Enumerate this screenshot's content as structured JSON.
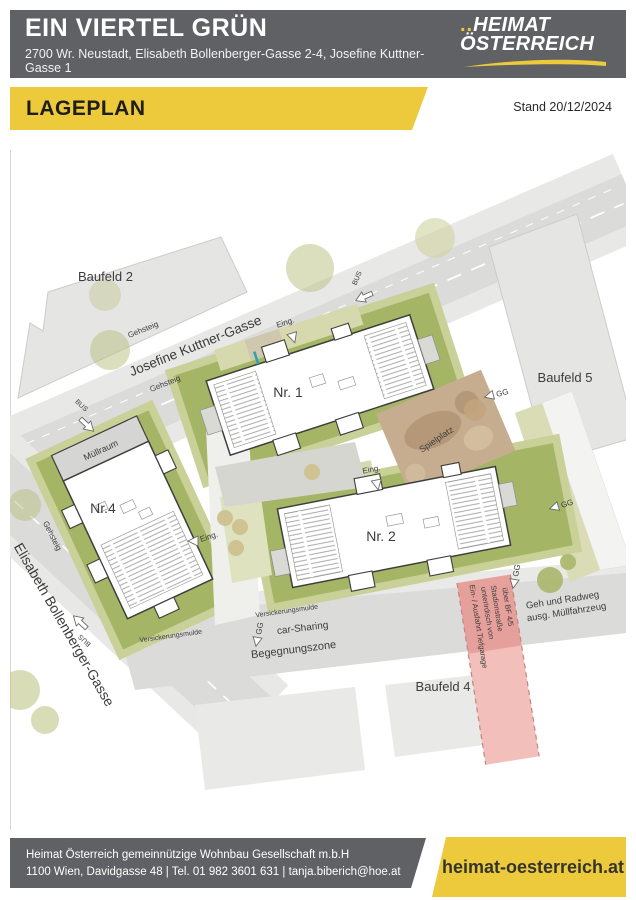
{
  "header": {
    "title": "EIN VIERTEL GRÜN",
    "subtitle": "2700 Wr. Neustadt, Elisabeth Bollenberger-Gasse 2-4, Josefine Kuttner-Gasse 1",
    "logo_dots": "..",
    "logo_line1": "HEIMAT",
    "logo_line2": "ÖSTERREICH"
  },
  "banner": {
    "label": "LAGEPLAN",
    "date": "Stand 20/12/2024"
  },
  "plan": {
    "blocks": {
      "baufeld2": "Baufeld 2",
      "baufeld4": "Baufeld 4",
      "baufeld5": "Baufeld 5"
    },
    "streets": {
      "josefine": "Josefine Kuttner-Gasse",
      "elisabeth": "Elisabeth Bollenberger-Gasse",
      "gehsteig": "Gehsteig",
      "begegnungszone": "Begegnungszone",
      "geh_radweg_1": "Geh und Radweg",
      "geh_radweg_2": "ausg. Müllfahrzeug"
    },
    "buildings": {
      "nr1": "Nr. 1",
      "nr2": "Nr. 2",
      "nr4": "Nr.4",
      "muellraum": "Müllraum"
    },
    "features": {
      "spielplatz": "Spielplatz",
      "car_sharing": "car-Sharing",
      "versickerungsmulde": "Versickerungsmulde",
      "eingang": "Eing.",
      "gg": "GG",
      "bus": "BUS",
      "tg_line1": "Ein- / Ausfahrt Tiefgarage",
      "tg_line2": "unterirdisch von",
      "tg_line3": "Stadionstraße",
      "tg_line4": "über BF 4/5"
    }
  },
  "footer": {
    "line1": "Heimat Österreich gemeinnützige Wohnbau Gesellschaft m.b.H",
    "line2": "1100 Wien, Davidgasse 48 | Tel. 01 982 3601 631 | tanja.biberich@hoe.at",
    "website": "heimat-oesterreich.at"
  },
  "colors": {
    "accent_yellow": "#edc93c",
    "header_gray": "#5f6164",
    "plan_green": "#a4b566",
    "plan_green_light": "#c9d098",
    "street_gray": "#dbdbda",
    "block_gray": "#e5e5e4",
    "playground_tan": "#c7ad90",
    "ramp_pink": "#e79d98",
    "ramp_pink_light": "#f1bcb7",
    "teal_mark": "#2fa3ad"
  }
}
